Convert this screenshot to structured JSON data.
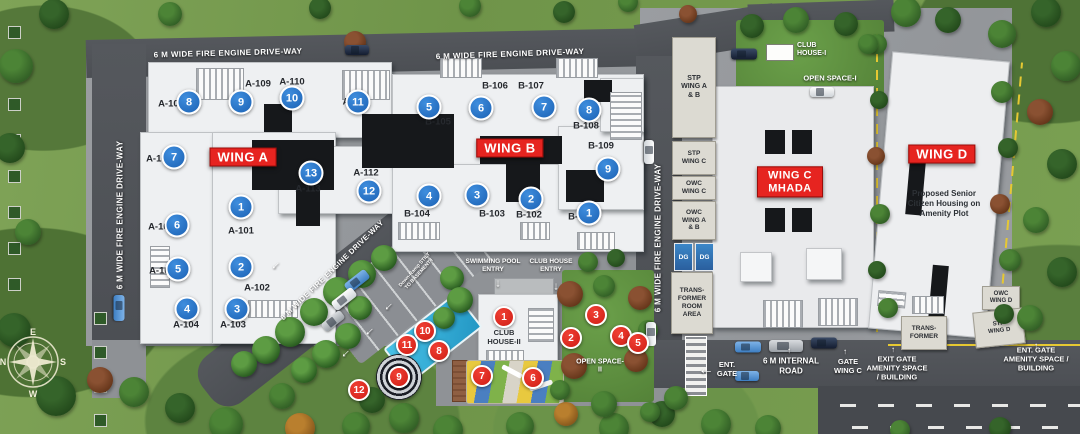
{
  "plan": {
    "roads": {
      "fire_driveway_6m": "6 M WIDE FIRE ENGINE DRIVE-WAY",
      "fire_driveway_8m": "8 M WIDE FIRE ENGINE DRIVE-WAY",
      "internal_road": "6 M INTERNAL ROAD",
      "ramp_note": "Down-Ramp STILT TO BASEMENT-I"
    },
    "wings": {
      "a": {
        "label": "WING A",
        "units": [
          {
            "n": "1",
            "code": "A-101"
          },
          {
            "n": "2",
            "code": "A-102"
          },
          {
            "n": "3",
            "code": "A-103"
          },
          {
            "n": "4",
            "code": "A-104"
          },
          {
            "n": "5",
            "code": "A-105"
          },
          {
            "n": "6",
            "code": "A-106"
          },
          {
            "n": "7",
            "code": "A-107"
          },
          {
            "n": "8",
            "code": "A-108"
          },
          {
            "n": "9",
            "code": "A-109"
          },
          {
            "n": "10",
            "code": "A-110"
          },
          {
            "n": "11",
            "code": "A-111"
          },
          {
            "n": "12",
            "code": "A-112"
          },
          {
            "n": "13",
            "code": "A-113"
          }
        ]
      },
      "b": {
        "label": "WING B",
        "units": [
          {
            "n": "1",
            "code": "B-101"
          },
          {
            "n": "2",
            "code": "B-102"
          },
          {
            "n": "3",
            "code": "B-103"
          },
          {
            "n": "4",
            "code": "B-104"
          },
          {
            "n": "5",
            "code": "B-105"
          },
          {
            "n": "6",
            "code": "B-106"
          },
          {
            "n": "7",
            "code": "B-107"
          },
          {
            "n": "8",
            "code": "B-108"
          },
          {
            "n": "9",
            "code": "B-109"
          }
        ]
      },
      "c": {
        "label": "WING C MHADA"
      },
      "d": {
        "label": "WING D",
        "note": "Proposed Senior Citizen Housing on Amenity Plot"
      }
    },
    "amenities": {
      "club_house_1": "CLUB HOUSE-I",
      "open_space_1": "OPEN SPACE-I",
      "club_house_2": "CLUB HOUSE-II",
      "open_space_2": "OPEN SPACE-II",
      "club_house_entry": "CLUB HOUSE ENTRY",
      "swimming_pool_entry": "SWIMMING POOL ENTRY",
      "markers": [
        "1",
        "2",
        "3",
        "4",
        "5",
        "6",
        "7",
        "8",
        "9",
        "10",
        "11",
        "12"
      ]
    },
    "services": {
      "stp_ab": "STP WING A & B",
      "stp_c": "STP WING C",
      "owc_c": "OWC WING C",
      "owc_ab": "OWC WING A & B",
      "dg": "DG",
      "transformer_room": "TRANS-FORMER ROOM AREA",
      "transformer": "TRANS-FORMER",
      "owc_d": "OWC WING D",
      "stp_d": "STP WING D"
    },
    "gates": {
      "ent_gate": "ENT. GATE",
      "gate_wing_c": "GATE WING C",
      "exit_gate_amenity": "EXIT GATE AMENITY SPACE / BUILDING",
      "ent_gate_amenity": "ENT. GATE AMENITY SPACE / BUILDING"
    },
    "compass": {
      "n": "N",
      "e": "E",
      "s": "S",
      "w": "W"
    }
  }
}
